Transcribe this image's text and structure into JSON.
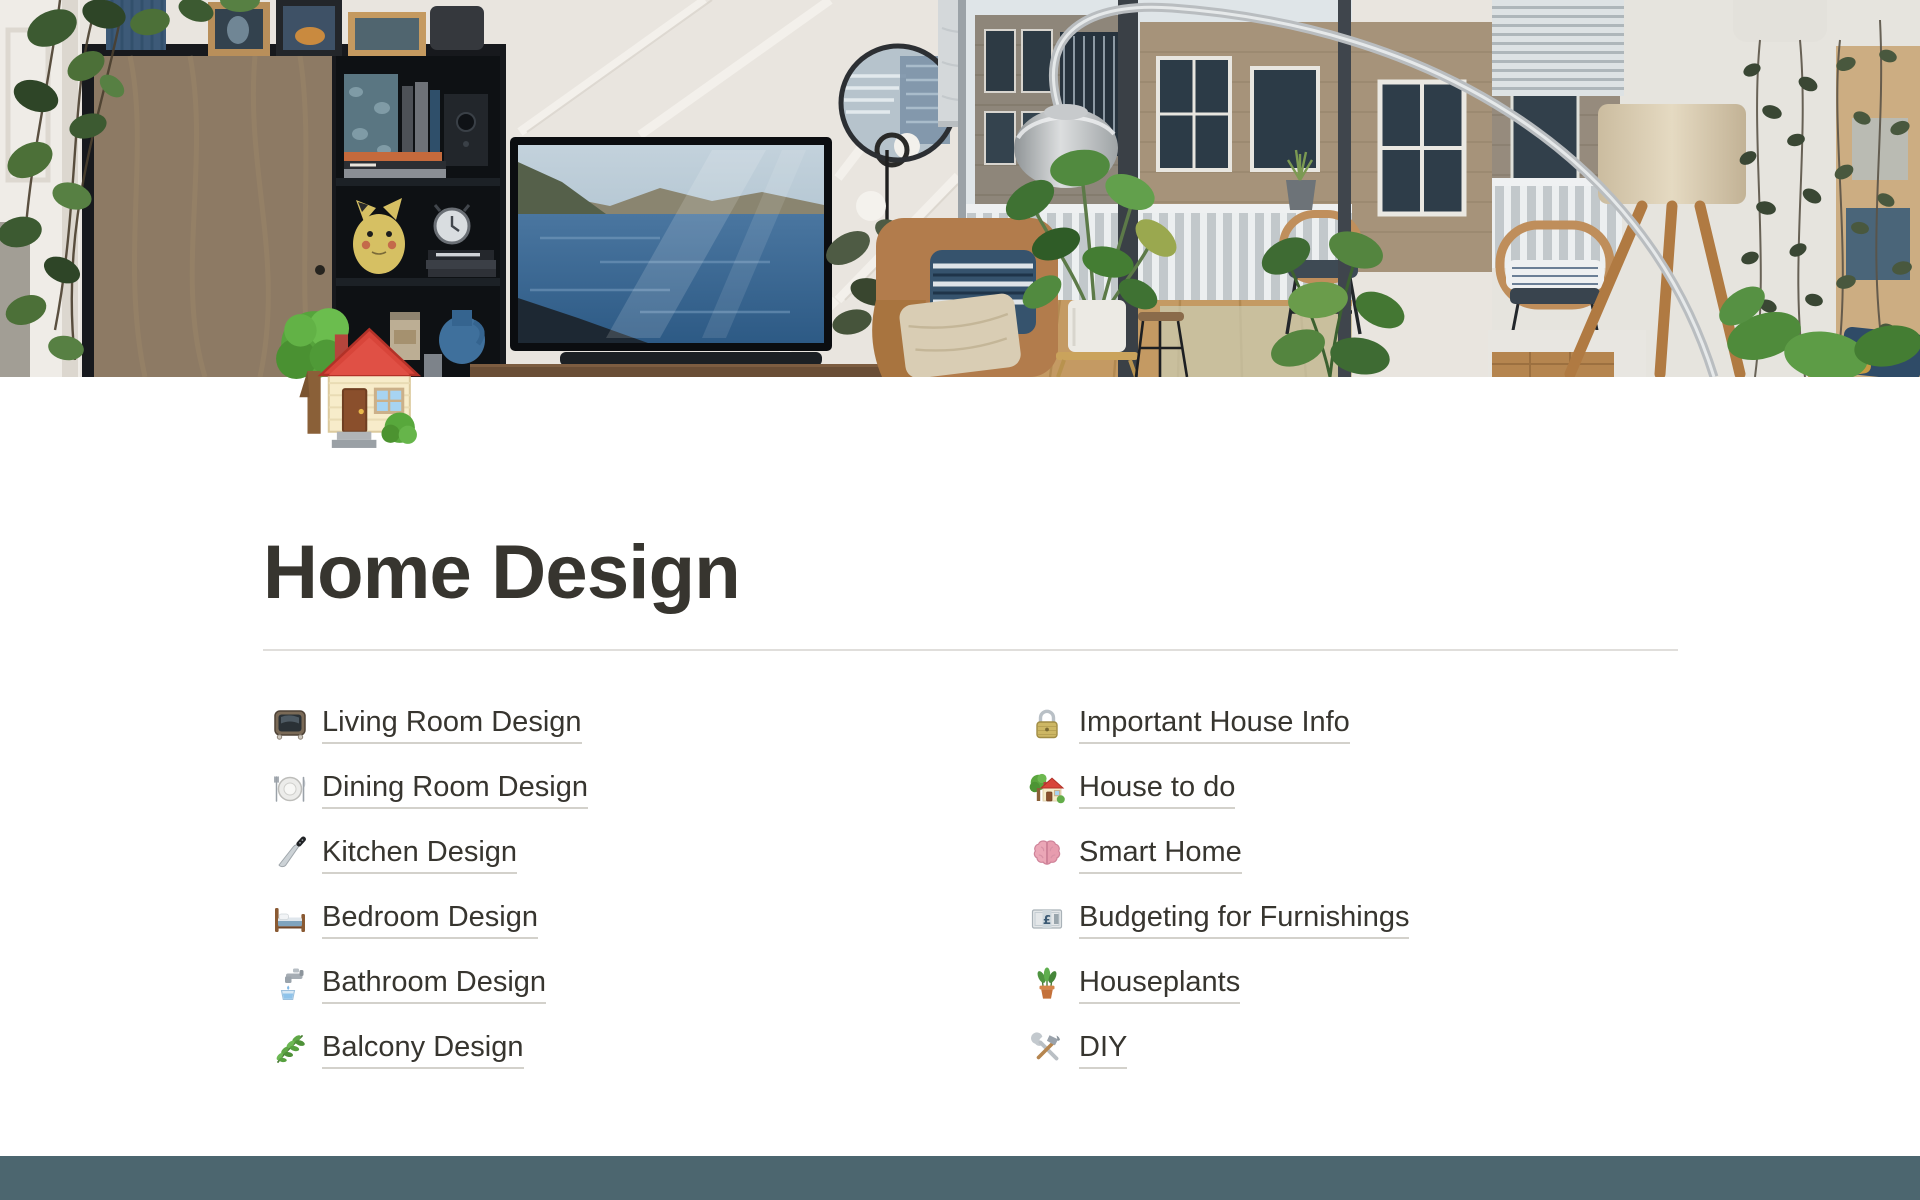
{
  "page": {
    "cover_alt": "Living room with hanging houseplants, wooden cabinet with shelves, TV showing a fjord landscape, round mirror, chrome arc lamp, tan armchair and balcony windows onto brick apartment buildings",
    "icon": "house-with-garden",
    "title": "Home Design"
  },
  "links": {
    "left": [
      {
        "icon": "tv",
        "label": "Living Room Design"
      },
      {
        "icon": "fork-and-knife-with-plate",
        "label": "Dining Room Design"
      },
      {
        "icon": "kitchen-knife",
        "label": "Kitchen Design"
      },
      {
        "icon": "bed",
        "label": "Bedroom Design"
      },
      {
        "icon": "potable-water",
        "label": "Bathroom Design"
      },
      {
        "icon": "herb",
        "label": "Balcony Design"
      }
    ],
    "right": [
      {
        "icon": "lock",
        "label": "Important House Info"
      },
      {
        "icon": "house-with-garden",
        "label": "House to do"
      },
      {
        "icon": "brain",
        "label": "Smart Home"
      },
      {
        "icon": "pound-banknote",
        "label": "Budgeting for Furnishings"
      },
      {
        "icon": "potted-plant",
        "label": "Houseplants"
      },
      {
        "icon": "hammer-and-wrench",
        "label": "DIY"
      }
    ]
  },
  "colors": {
    "text": "#37352f",
    "link_underline": "#d3d1cb",
    "divider": "#e0dedb",
    "background": "#ffffff",
    "bottom_bar": "#4c666f"
  }
}
